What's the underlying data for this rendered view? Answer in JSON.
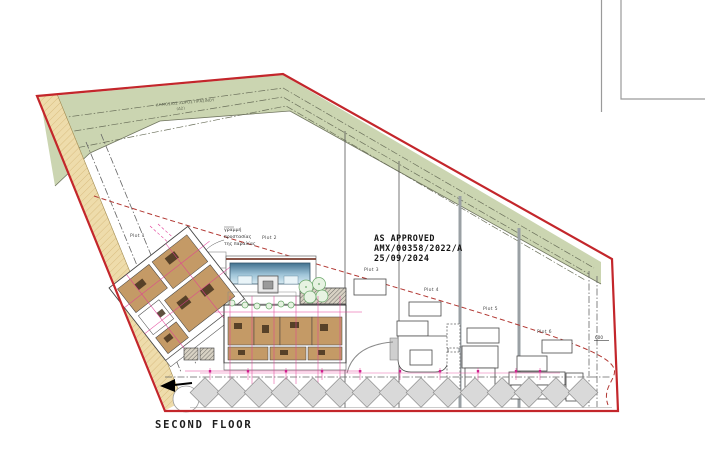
{
  "drawing": {
    "title": "SECOND FLOOR",
    "approval_stamp": {
      "line1": "AS APPROVED",
      "line2": "AMX/00358/2022/A",
      "line3": "25/09/2024"
    },
    "green_area_label": {
      "line1": "ΔΗΜΟΣΙΟΣ ΧΩΡΟΣ ΠΡΑΣΙΝΟΥ",
      "line2": "(Δ2)"
    },
    "beach_protection_label": {
      "line1": "γραμμή",
      "line2": "προστασίας",
      "line3": "της παραλίας"
    },
    "plots": [
      {
        "label": "Plot 1"
      },
      {
        "label": "Plot 2"
      },
      {
        "label": "Plot 3"
      },
      {
        "label": "Plot 4"
      },
      {
        "label": "Plot 5"
      },
      {
        "label": "Plot 6"
      }
    ],
    "dimensions": {
      "right_setback": "600"
    }
  },
  "colors": {
    "site_boundary_red": "#c3262b",
    "public_green": "#cbd5b1",
    "coastal_sand": "#eedcab",
    "beach_line_red": "#b23833",
    "room_tan": "#c49a66",
    "dimension_magenta": "#e23c96",
    "pool_blue": "#6f9cba",
    "tree_green": "#6aa86a",
    "divider_gray": "#9aa0a4"
  }
}
